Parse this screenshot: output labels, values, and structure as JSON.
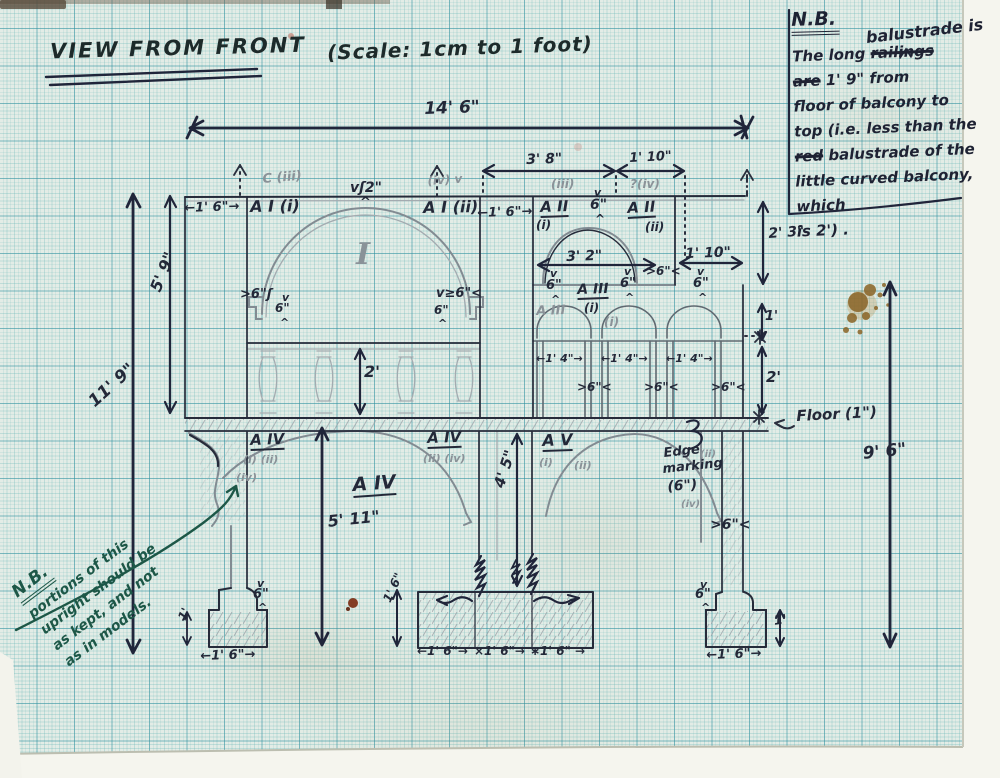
{
  "colors": {
    "paper": "#e3ece6",
    "grid_minor": "#6eb9b9",
    "grid_major": "#2a8c9e",
    "ink": "#232838",
    "pencil": "#8a9298",
    "green_ink": "#1d5747",
    "stain_brown": "#8a6426",
    "rust": "#7a2a10"
  },
  "title": {
    "main": "VIEW FROM FRONT",
    "scale": "(Scale: 1cm to 1 foot)"
  },
  "note_top_right": {
    "heading": "N.B.",
    "insert": "balustrade is",
    "lines": [
      [
        {
          "t": "The long "
        },
        {
          "t": "railings",
          "strike": true
        }
      ],
      [
        {
          "t": "are",
          "strike": true
        },
        {
          "t": " 1' 9\" from"
        }
      ],
      [
        {
          "t": "floor of balcony to"
        }
      ],
      [
        {
          "t": "top (i.e. less than the"
        }
      ],
      [
        {
          "t": "red",
          "strike": true
        },
        {
          "t": " balustrade of the"
        }
      ],
      [
        {
          "t": "little curved balcony, which"
        }
      ],
      [
        {
          "t": "is 2') ."
        }
      ]
    ]
  },
  "note_bottom_left": {
    "heading": "N.B.",
    "lines": [
      "portions of this",
      "upright should be",
      "as kept, and not",
      "as in models."
    ]
  },
  "annotations": [
    {
      "n": "dim-14ft-6in",
      "t": "14' 6\"",
      "x": 424,
      "y": 101,
      "s": 17,
      "r": -2
    },
    {
      "n": "dim-3ft-8in",
      "t": "3' 8\"",
      "x": 526,
      "y": 153,
      "s": 14,
      "r": -2
    },
    {
      "n": "dim-1ft-10in-top",
      "t": "1' 10\"",
      "x": 629,
      "y": 152,
      "s": 13,
      "r": -3
    },
    {
      "n": "dim-1ft-6in-left",
      "t": "←1' 6\"→",
      "x": 184,
      "y": 202,
      "s": 13,
      "r": -2
    },
    {
      "n": "label-A-I-i",
      "t": "A I (i)",
      "x": 250,
      "y": 199,
      "s": 16,
      "r": -1
    },
    {
      "n": "label-C-iii",
      "t": "C (iii)",
      "x": 262,
      "y": 173,
      "s": 13,
      "r": -5,
      "k": "p"
    },
    {
      "n": "dim-2in-apex",
      "t": "vʃ2\"",
      "x": 350,
      "y": 181,
      "s": 14
    },
    {
      "n": "apex-caret",
      "t": "^",
      "x": 360,
      "y": 196,
      "s": 13
    },
    {
      "n": "label-iv-upper",
      "t": "(iv) v",
      "x": 427,
      "y": 175,
      "s": 12,
      "r": -4,
      "k": "p"
    },
    {
      "n": "label-A-I-ii",
      "t": "A I (ii)",
      "x": 423,
      "y": 200,
      "s": 16,
      "r": -1
    },
    {
      "n": "dim-1ft-6in-mid",
      "t": "←1' 6\"→",
      "x": 477,
      "y": 207,
      "s": 13,
      "r": -2
    },
    {
      "n": "label-iii-above",
      "t": "(iii)",
      "x": 551,
      "y": 178,
      "s": 12,
      "k": "p"
    },
    {
      "n": "label-A-II-i",
      "t": "A II",
      "x": 540,
      "y": 200,
      "s": 15,
      "r": -2,
      "u": 1
    },
    {
      "n": "label-A-II-i-sub",
      "t": "(i)",
      "x": 536,
      "y": 219,
      "s": 12
    },
    {
      "n": "mark-v-balcony",
      "t": "v",
      "x": 594,
      "y": 187,
      "s": 11
    },
    {
      "n": "dim-6in-balcony",
      "t": "6\"",
      "x": 590,
      "y": 198,
      "s": 14
    },
    {
      "n": "mark-caret-balcony",
      "t": "^",
      "x": 595,
      "y": 213,
      "s": 12
    },
    {
      "n": "label-iv-above",
      "t": "?(iv)",
      "x": 630,
      "y": 178,
      "s": 12,
      "k": "p"
    },
    {
      "n": "label-A-II-ii",
      "t": "A II",
      "x": 627,
      "y": 201,
      "s": 15,
      "r": -3,
      "u": 1
    },
    {
      "n": "label-A-II-ii-sub",
      "t": "(ii)",
      "x": 645,
      "y": 221,
      "s": 12
    },
    {
      "n": "dim-2ft-3in",
      "t": "2' 3\"",
      "x": 768,
      "y": 227,
      "s": 14,
      "r": -4
    },
    {
      "n": "dim-5ft-9in",
      "t": "5' 9\"",
      "x": 148,
      "y": 288,
      "s": 16,
      "r": -68
    },
    {
      "n": "dim-11ft-9in",
      "t": "11' 9\"",
      "x": 86,
      "y": 398,
      "s": 17,
      "r": -42
    },
    {
      "n": "spring-left-6in",
      "t": ">6\"ʃ",
      "x": 240,
      "y": 288,
      "s": 13
    },
    {
      "n": "spring-left-v",
      "t": "v",
      "x": 282,
      "y": 292,
      "s": 11
    },
    {
      "n": "spring-left-6in-b",
      "t": "6\"",
      "x": 275,
      "y": 302,
      "s": 12
    },
    {
      "n": "spring-left-caret",
      "t": "^",
      "x": 280,
      "y": 317,
      "s": 11
    },
    {
      "n": "spring-right-6in",
      "t": "v≥6\"<",
      "x": 436,
      "y": 287,
      "s": 13
    },
    {
      "n": "spring-right-6in-b",
      "t": "6\"",
      "x": 434,
      "y": 304,
      "s": 12
    },
    {
      "n": "spring-right-caret",
      "t": "^",
      "x": 438,
      "y": 318,
      "s": 11
    },
    {
      "n": "label-bay-I",
      "t": "I",
      "x": 356,
      "y": 240,
      "s": 30,
      "k": "ps"
    },
    {
      "n": "dim-3ft-2in",
      "t": "3' 2\"",
      "x": 566,
      "y": 250,
      "s": 14,
      "r": -2
    },
    {
      "n": "dim-1ft-10in-low",
      "t": "1' 10\"",
      "x": 685,
      "y": 247,
      "s": 14,
      "r": -2
    },
    {
      "n": "dim-6in-gap",
      "t": ">6\"<",
      "x": 646,
      "y": 265,
      "s": 12
    },
    {
      "n": "label-A-III-ink",
      "t": "A III",
      "x": 577,
      "y": 283,
      "s": 14,
      "r": -2,
      "u": 1
    },
    {
      "n": "label-A-III-sub",
      "t": "(i)",
      "x": 584,
      "y": 302,
      "s": 12
    },
    {
      "n": "label-A-III-pencil",
      "t": "A III",
      "x": 536,
      "y": 305,
      "s": 13,
      "r": -2,
      "k": "p"
    },
    {
      "n": "label-A-III-p-sub",
      "t": "(i)",
      "x": 604,
      "y": 316,
      "s": 12,
      "k": "p"
    },
    {
      "n": "arch1-v",
      "t": "v",
      "x": 550,
      "y": 268,
      "s": 11
    },
    {
      "n": "arch1-6in",
      "t": "6\"",
      "x": 546,
      "y": 279,
      "s": 13
    },
    {
      "n": "arch1-caret",
      "t": "^",
      "x": 551,
      "y": 294,
      "s": 11
    },
    {
      "n": "arch2-v",
      "t": "v",
      "x": 624,
      "y": 266,
      "s": 11
    },
    {
      "n": "arch2-6in",
      "t": "6\"",
      "x": 620,
      "y": 277,
      "s": 13
    },
    {
      "n": "arch2-caret",
      "t": "^",
      "x": 625,
      "y": 292,
      "s": 11
    },
    {
      "n": "arch3-v",
      "t": "v",
      "x": 697,
      "y": 266,
      "s": 11
    },
    {
      "n": "arch3-6in",
      "t": "6\"",
      "x": 693,
      "y": 277,
      "s": 13
    },
    {
      "n": "arch3-caret",
      "t": "^",
      "x": 698,
      "y": 292,
      "s": 11
    },
    {
      "n": "dim-1ft-right",
      "t": "1'",
      "x": 765,
      "y": 310,
      "s": 13
    },
    {
      "n": "dim-2ft-right",
      "t": "2'",
      "x": 766,
      "y": 370,
      "s": 15
    },
    {
      "n": "dim-1ft-4in-1",
      "t": "←1' 4\"→",
      "x": 536,
      "y": 353,
      "s": 11
    },
    {
      "n": "dim-1ft-4in-2",
      "t": "←1' 4\"→",
      "x": 601,
      "y": 353,
      "s": 11
    },
    {
      "n": "dim-1ft-4in-3",
      "t": "←1' 4\"→",
      "x": 666,
      "y": 353,
      "s": 11
    },
    {
      "n": "dim-6in-pier1",
      "t": ">6\"<",
      "x": 577,
      "y": 381,
      "s": 12
    },
    {
      "n": "dim-6in-pier2",
      "t": ">6\"<",
      "x": 644,
      "y": 381,
      "s": 12
    },
    {
      "n": "dim-6in-pier3",
      "t": ">6\"<",
      "x": 711,
      "y": 381,
      "s": 12
    },
    {
      "n": "dim-2ft-balustrade",
      "t": "2'",
      "x": 364,
      "y": 364,
      "s": 16
    },
    {
      "n": "floor-label",
      "t": "Floor (1\")",
      "x": 796,
      "y": 409,
      "s": 15,
      "r": -3
    },
    {
      "n": "label-A-IV-left",
      "t": "A IV",
      "x": 250,
      "y": 433,
      "s": 15,
      "r": -2,
      "u": 1
    },
    {
      "n": "label-A-IV-left-sub",
      "t": "(i) (ii)",
      "x": 243,
      "y": 454,
      "s": 11,
      "k": "p"
    },
    {
      "n": "label-A-IV-left-sub2",
      "t": "(iv)",
      "x": 236,
      "y": 472,
      "s": 11,
      "k": "p"
    },
    {
      "n": "label-A-IV-right",
      "t": "A IV",
      "x": 427,
      "y": 431,
      "s": 15,
      "r": -2,
      "u": 1
    },
    {
      "n": "label-A-IV-right-sub",
      "t": "(ii) (iv)",
      "x": 423,
      "y": 453,
      "s": 11,
      "k": "p"
    },
    {
      "n": "label-A-V",
      "t": "A V",
      "x": 542,
      "y": 433,
      "s": 16,
      "r": -2,
      "u": 1
    },
    {
      "n": "label-A-V-sub",
      "t": "(i)",
      "x": 539,
      "y": 457,
      "s": 11,
      "k": "p"
    },
    {
      "n": "label-A-V-sub2",
      "t": "(ii)",
      "x": 574,
      "y": 460,
      "s": 11,
      "k": "p"
    },
    {
      "n": "label-A-IV-center",
      "t": "A IV",
      "x": 352,
      "y": 476,
      "s": 19,
      "r": -4,
      "u": 1
    },
    {
      "n": "dim-5ft-11in",
      "t": "5' 11\"",
      "x": 327,
      "y": 514,
      "s": 16,
      "r": -6
    },
    {
      "n": "dim-4ft-5in",
      "t": "4' 5\"",
      "x": 492,
      "y": 485,
      "s": 15,
      "r": -72
    },
    {
      "n": "edge-marking-1",
      "t": "Edge",
      "x": 663,
      "y": 447,
      "s": 13,
      "r": -6
    },
    {
      "n": "edge-marking-1-sub",
      "t": "(ii)",
      "x": 700,
      "y": 450,
      "s": 10,
      "k": "p"
    },
    {
      "n": "edge-marking-2",
      "t": "marking",
      "x": 662,
      "y": 463,
      "s": 13,
      "r": -6
    },
    {
      "n": "edge-marking-3",
      "t": "(6\")",
      "x": 667,
      "y": 480,
      "s": 14,
      "r": -4
    },
    {
      "n": "edge-marking-sub2",
      "t": "(iv)",
      "x": 681,
      "y": 500,
      "s": 10,
      "k": "p"
    },
    {
      "n": "dim-6in-right-pier",
      "t": ">6\"<",
      "x": 710,
      "y": 518,
      "s": 14
    },
    {
      "n": "dim-9ft-6in",
      "t": "9' 6\"",
      "x": 862,
      "y": 446,
      "s": 17,
      "r": -6
    },
    {
      "n": "base-left-v",
      "t": "v",
      "x": 257,
      "y": 578,
      "s": 11
    },
    {
      "n": "base-left-6in",
      "t": "6\"",
      "x": 253,
      "y": 588,
      "s": 13
    },
    {
      "n": "base-left-caret",
      "t": "^",
      "x": 258,
      "y": 602,
      "s": 11
    },
    {
      "n": "base-left-1ft",
      "t": "1'",
      "x": 176,
      "y": 617,
      "s": 12,
      "r": -65
    },
    {
      "n": "base-left-1ft6in",
      "t": "←1' 6\"→",
      "x": 200,
      "y": 650,
      "s": 13,
      "r": -2
    },
    {
      "n": "plinth-1ft6in-vert",
      "t": "1' 6\"",
      "x": 381,
      "y": 599,
      "s": 12,
      "r": -65
    },
    {
      "n": "plinth-1ft6in-1",
      "t": "←1' 6\"→",
      "x": 417,
      "y": 645,
      "s": 12
    },
    {
      "n": "plinth-1ft6in-2",
      "t": "×1' 6\"→",
      "x": 474,
      "y": 645,
      "s": 12
    },
    {
      "n": "plinth-1ft6in-3",
      "t": "∗1' 6\" →",
      "x": 530,
      "y": 645,
      "s": 12
    },
    {
      "n": "base-right-v",
      "t": "v",
      "x": 700,
      "y": 579,
      "s": 11
    },
    {
      "n": "base-right-6in",
      "t": "6\"",
      "x": 695,
      "y": 588,
      "s": 13
    },
    {
      "n": "base-right-caret",
      "t": "^",
      "x": 701,
      "y": 602,
      "s": 11
    },
    {
      "n": "base-right-1ft",
      "t": "1'",
      "x": 773,
      "y": 615,
      "s": 13,
      "r": -8
    },
    {
      "n": "base-right-1ft6in",
      "t": "←1' 6\"→",
      "x": 706,
      "y": 649,
      "s": 13,
      "r": -2
    }
  ]
}
